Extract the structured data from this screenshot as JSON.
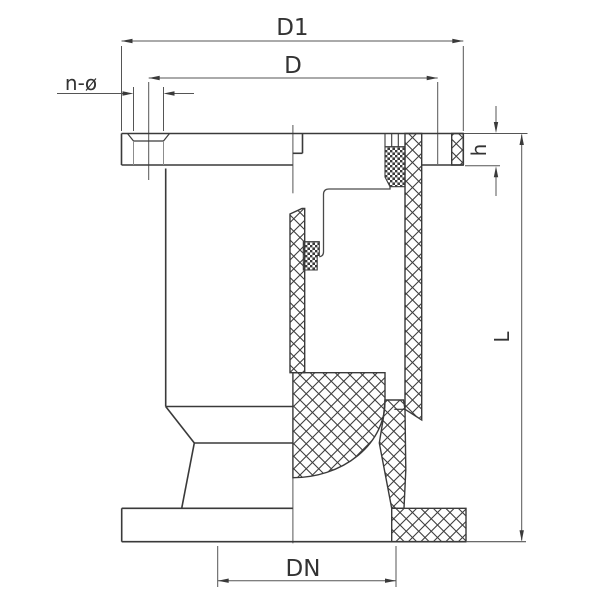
{
  "drawing": {
    "dimension_labels": {
      "outer_flange_diameter": "D1",
      "bolt_circle_diameter": "D",
      "bolt_holes": "n-ø",
      "flange_thickness": "h",
      "overall_height": "L",
      "nominal_diameter": "DN"
    },
    "colors": {
      "outline": "#3a3a3a",
      "dimension_line": "#555555",
      "hidden_line": "#8d8d8d",
      "background": "#ffffff"
    }
  }
}
